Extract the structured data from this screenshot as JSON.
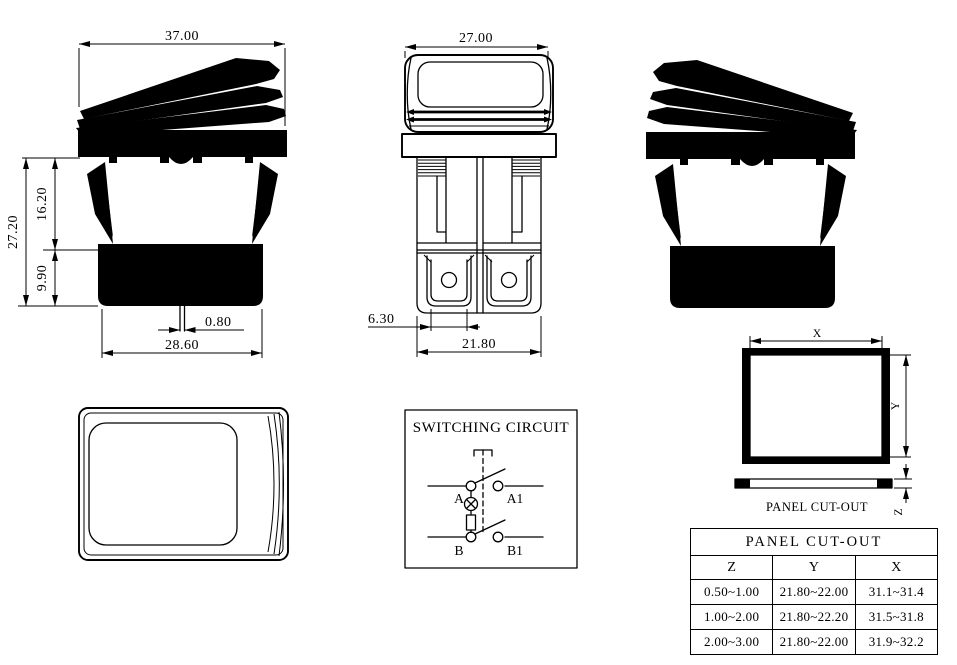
{
  "page": {
    "background": "#ffffff",
    "line_color": "#000000"
  },
  "views": {
    "side_left": {
      "label": "side-view-left",
      "dims": {
        "width": "37.00",
        "total_height": "27.20",
        "upper_height": "16.20",
        "lower_height": "9.90",
        "pin_width": "0.80",
        "base_width": "28.60"
      }
    },
    "front": {
      "label": "front-view",
      "dims": {
        "width": "27.00",
        "terminal_width": "6.30",
        "body_width": "21.80"
      }
    },
    "side_right": {
      "label": "side-view-right"
    },
    "top": {
      "label": "top-view"
    }
  },
  "circuit": {
    "title": "SWITCHING CIRCUIT",
    "terminals": {
      "a": "A",
      "a1": "A1",
      "b": "B",
      "b1": "B1"
    }
  },
  "panel_cutout": {
    "caption": "PANEL CUT-OUT",
    "dim_x": "X",
    "dim_y": "Y",
    "dim_z": "Z"
  },
  "table": {
    "title": "PANEL CUT-OUT",
    "headers": [
      "Z",
      "Y",
      "X"
    ],
    "rows": [
      [
        "0.50~1.00",
        "21.80~22.00",
        "31.1~31.4"
      ],
      [
        "1.00~2.00",
        "21.80~22.20",
        "31.5~31.8"
      ],
      [
        "2.00~3.00",
        "21.80~22.00",
        "31.9~32.2"
      ]
    ]
  }
}
